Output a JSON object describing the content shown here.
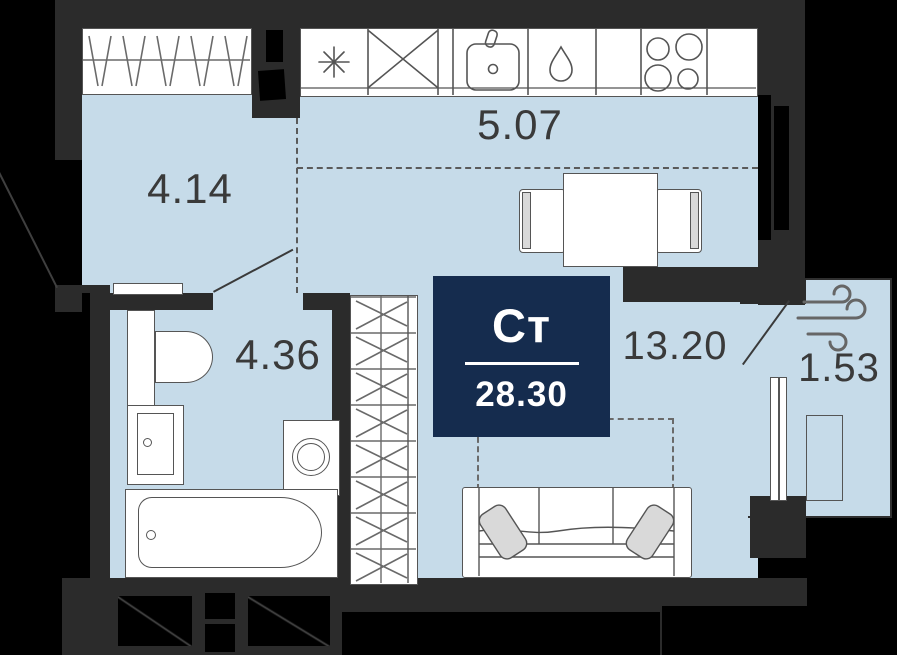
{
  "meta": {
    "plan_type_label": "Ст",
    "total_area": "28.30"
  },
  "rooms": [
    {
      "name": "hallway",
      "area": "4.14"
    },
    {
      "name": "kitchen",
      "area": "5.07"
    },
    {
      "name": "bathroom",
      "area": "4.36"
    },
    {
      "name": "living-room",
      "area": "13.20"
    },
    {
      "name": "balcony",
      "area": "1.53"
    }
  ],
  "icons": {
    "fridge": "snowflake-icon",
    "kitchen_unit": "cross-box-icon",
    "kitchen_sink": "sink-icon",
    "dishwasher": "water-drop-icon",
    "stove": "hob-burners-icon",
    "balcony_ventilation": "wind-icon"
  },
  "colors": {
    "floor": "#c6dbe9",
    "walls": "#2b2b2b",
    "outside": "#000000",
    "fixture_outline": "#555555",
    "badge_background": "#152c4e",
    "badge_text": "#ffffff",
    "label_text": "#3a3a3a"
  }
}
